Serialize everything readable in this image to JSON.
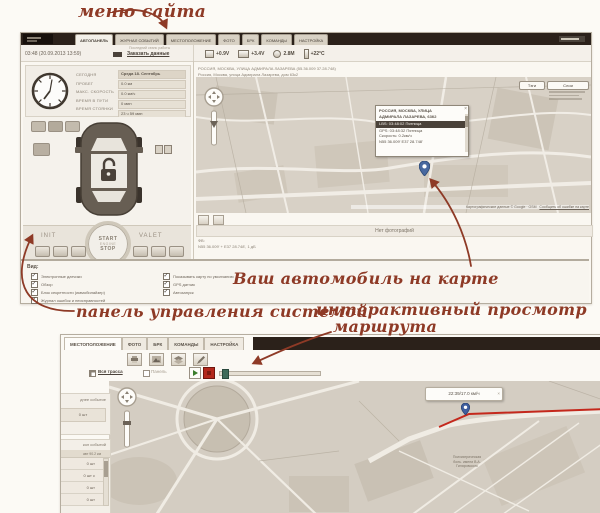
{
  "colors": {
    "annotation": "#8e3a26",
    "header_dark": "#2b211a",
    "route_red": "#c4281c",
    "play_green": "#3a7d2c",
    "stop_red": "#b3281c",
    "pin_blue": "#48689f"
  },
  "annotations": {
    "site_menu": "меню сайта",
    "car_on_map": "Ваш автомобиль на карте",
    "control_panel": "панель управления системой",
    "route_view_line1": "интерактивный просмотр",
    "route_view_line2": "маршрута"
  },
  "top_window": {
    "tabs": [
      "АВТОПАНЕЛЬ",
      "ЖУРНАЛ СОБЫТИЙ",
      "МЕСТОПОЛОЖЕНИЕ",
      "ФОТО",
      "БРК",
      "КОМАНДЫ",
      "НАСТРОЙКА"
    ],
    "status": {
      "session_label": "Последний сеанс работы",
      "datetime": "03:48 (20.09.2013 13:59)",
      "order_link": "Заказать данные",
      "stats": [
        {
          "icon": "battery-icon",
          "value": "+0.9V"
        },
        {
          "icon": "power-icon",
          "value": "+3.4V"
        },
        {
          "icon": "antenna-icon",
          "value": "2.8М"
        },
        {
          "icon": "thermometer-icon",
          "value": "+22°C"
        }
      ]
    },
    "summary": {
      "labels": [
        "СЕГОДНЯ",
        "ПРОБЕГ",
        "МАКС. СКОРОСТЬ",
        "ВРЕМЯ В ПУТИ",
        "ВРЕМЯ СТОЯНКИ"
      ],
      "values": [
        "Среда 18. Сентябрь",
        "0.0 км",
        "0.0 км/ч",
        "0 мин",
        "23 ч 59 мин"
      ]
    },
    "engine_controls": {
      "init": "INIT",
      "start": "START",
      "engine": "ENGINE",
      "stop": "STOP",
      "valet": "VALET"
    },
    "view_options": {
      "title": "Вид:",
      "left": [
        "Электронные датчики",
        "Обзор",
        "Блок секретности (иммобилайзер)",
        "Журнал ошибок и неисправностей"
      ],
      "right": [
        "Показывать карту по умолчанию",
        "GPS датчик",
        "Автозапуск"
      ]
    },
    "map": {
      "address_line1": "РОССИЯ, МОСКВА, УЛИЦА АДМИРАЛА ЛАЗАРЕВА (55.36.009 37.28.748)",
      "address_line2": "Россия, Москва, улица Адмирала Лазарева, дом 63к2",
      "tags_button": "Тэги",
      "layers_button": "Слои",
      "popup": {
        "line1": "РОССИЯ, МОСКВА, УЛИЦА",
        "line2": "АДМИРАЛА ЛАЗАРЕВА, 63К2",
        "lbs_row": "LBS: 03:48:02 Пятница",
        "gps_row": "GPS: 03:48:32 Пятница",
        "speed_row": "Скорость: 0.2км/ч",
        "coords_row": "N55 36.009'  E37 28.748'",
        "close": "×"
      },
      "attribution": "Картографические данные © Google · OSM",
      "report_link": "Сообщить об ошибке на карте",
      "no_photos": "Нет фотографий",
      "meta_label": "ФВ:",
      "meta_line": "N55 36.009' + E37 28.748', 1 дБ"
    }
  },
  "bottom_window": {
    "tabs": [
      "МЕСТОПОЛОЖЕНИЕ",
      "ФОТО",
      "БРК",
      "КОМАНДЫ",
      "НАСТРОЙКА"
    ],
    "controls": {
      "track_link": "Вся трасса",
      "panel_label": "Панель"
    },
    "sidebar": {
      "card1_title": "днее событие",
      "card1_value": "0 шт",
      "card2_title": "кол событий",
      "table_meta": "авт 90.2 км",
      "rows": [
        "0 шт",
        "0 шт с",
        "0 шт",
        "0 шт"
      ]
    },
    "map": {
      "tooltip": "22:39/17.0 км/ч",
      "tooltip_close": "×",
      "poi_line1": "Психиатрическая",
      "poi_line2": "боль. имени В.А.",
      "poi_line3": "Гиляровского"
    }
  }
}
